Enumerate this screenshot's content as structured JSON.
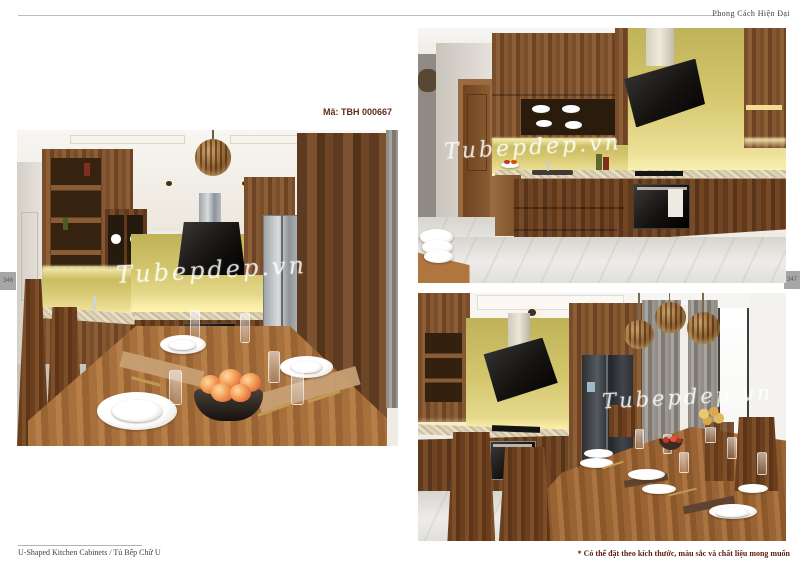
{
  "header": {
    "category": "Phong Cách Hiện Đại"
  },
  "product": {
    "code_label": "Mã: TBH 000667"
  },
  "watermark": {
    "text": "Tubepdep.vn"
  },
  "page_numbers": {
    "left": "346",
    "right": "347"
  },
  "footer": {
    "caption": "U-Shaped Kitchen Cabinets  /  Tủ Bếp Chữ U",
    "note": "* Có thể đặt theo kích thước, màu sắc và chất liệu mong muốn"
  },
  "colors": {
    "accent_text": "#5d2c1a",
    "note_text": "#5d2112",
    "backsplash_yellow": "#d3c66c",
    "cabinet_wood": "#7a4e2b",
    "page_tab_gray": "#a6a6a6"
  }
}
